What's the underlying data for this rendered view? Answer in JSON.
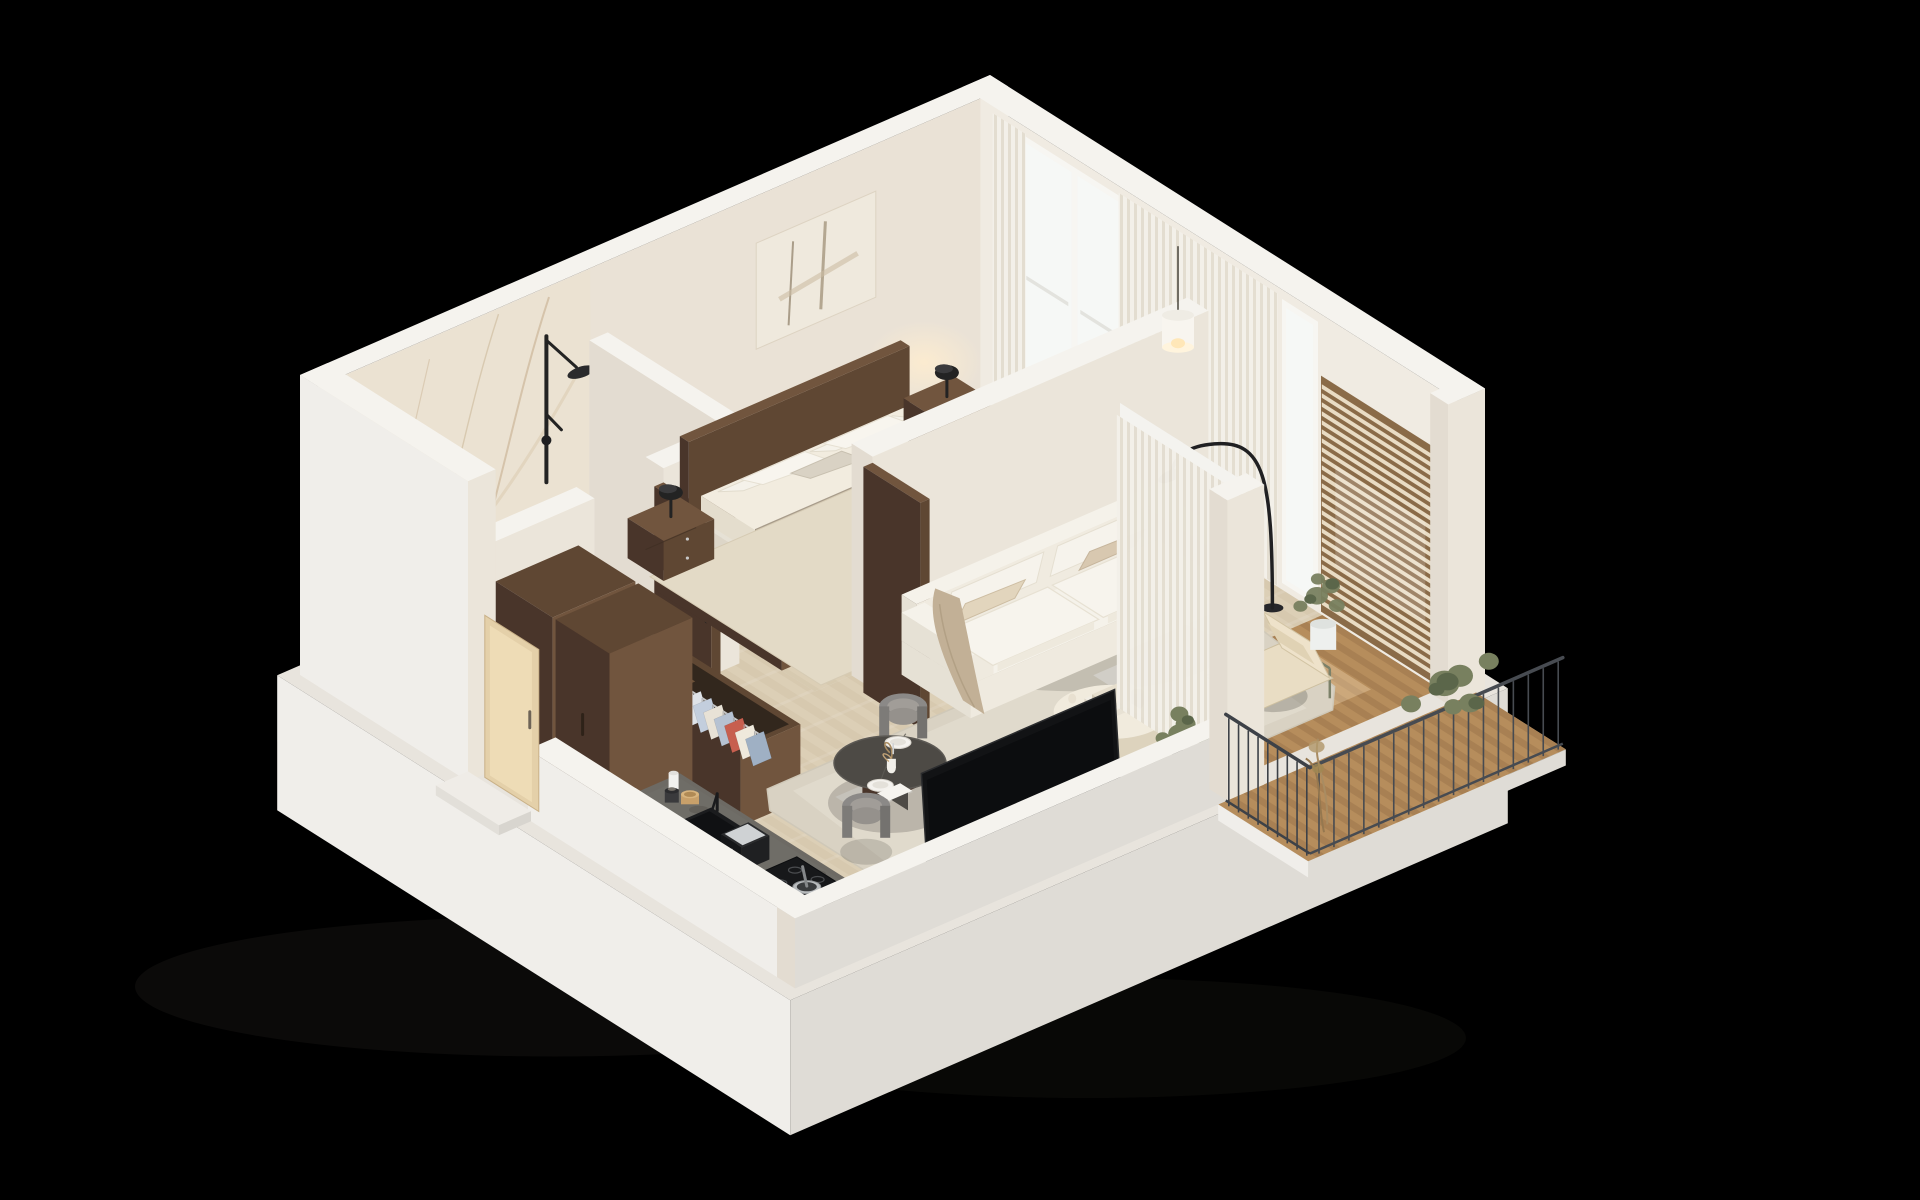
{
  "meta": {
    "description": "Photorealistic 3D isometric cutaway floor plan render of a studio apartment on a black background",
    "view": "axonometric cutaway, walls cut low at front",
    "background": "#000000"
  },
  "palette": {
    "background": "#000000",
    "wall_top": "#f5f3ee",
    "wall_face_left": "#e3dcd1",
    "wall_face_right": "#ebe5da",
    "wall_inner_back": "#eae2d6",
    "wall_inner_side": "#f0ebe2",
    "slab_top": "#e8e4dd",
    "slab_face_left": "#f0eeea",
    "slab_face_right": "#dfdcd6",
    "marble": "#ebe2d2",
    "marble_vein": "#c2aa88",
    "floor_wood": "#dccfb6",
    "floor_wood_dark": "#d0c2a7",
    "floor_bath": "#e7ddca",
    "floor_bath_seam": "#d8cbb4",
    "rug": "#d9d2c3",
    "rug_light": "#e8e2d5",
    "rug_bed": "#e3dac6",
    "deck": "#b68d5c",
    "deck_dark": "#99744a",
    "walnut": "#5f4733",
    "walnut_dark": "#49352a",
    "walnut_light": "#71553e",
    "white_furniture": "#f5f2ea",
    "white_shade": "#e6e1d5",
    "duvet": "#a89c8b",
    "duvet_light": "#b7ab9a",
    "linen": "#f2ecdf",
    "pillow_beige": "#d8c8b0",
    "throw": "#c2b096",
    "counter_stone": "#6d6a64",
    "counter_stone_dark": "#56534e",
    "counter_base": "#dedad2",
    "appliance_black": "#1b1c1e",
    "tv_black": "#121315",
    "chair_grey": "#8b8987",
    "table_wood": "#4d4a45",
    "curtain": "#f3f0e9",
    "curtain_shade": "#e3ddd0",
    "glass": "#e9eef0",
    "glass_bright": "#f6f8f6",
    "slat_wood": "#8a6b48",
    "slat_light": "#e9dcc4",
    "railing": "#474b51",
    "plant_green": "#78805f",
    "plant_dark": "#5b664a",
    "plant_dry": "#a98c62",
    "pot_white": "#eef0ee",
    "lamp_black": "#232323",
    "lamp_glow": "#ffedcf",
    "cream": "#ece4d2",
    "cream_dark": "#ddd3bd",
    "steel": "#b9bcbe",
    "chrome": "#cfd2d4",
    "door_light_wood": "#e4d0a9",
    "shadow": "#141310"
  },
  "rooms": [
    {
      "name": "bathroom",
      "items": [
        "marble feature wall",
        "black rain shower set",
        "freestanding oval bathtub",
        "wall-hung toilet",
        "walnut vanity with dark stone top and round white basin"
      ]
    },
    {
      "name": "bedroom",
      "items": [
        "double bed with walnut headboard",
        "white pillows",
        "taupe duvet",
        "walnut nightstand left",
        "walnut nightstand right",
        "black mushroom table lamps",
        "abstract textured artwork",
        "floor-to-ceiling window with sheer curtains",
        "open wardrobe with hanging clothes"
      ]
    },
    {
      "name": "hallway",
      "items": [
        "light wood entry door",
        "open closet with hanging clothes and shoe shelves",
        "tall walnut cabinets",
        "open walnut interior doors"
      ]
    },
    {
      "name": "living-room",
      "items": [
        "white three-seat sofa",
        "beige cushions and throw",
        "round cream coffee table with books and vases",
        "large flecked beige rug",
        "black arc floor lamp",
        "white cylinder pendant lamp",
        "round dark wood dining table with plates",
        "two grey barrel dining chairs",
        "TV console with black flat screen"
      ]
    },
    {
      "name": "kitchen",
      "items": [
        "dark stone countertop along low wall",
        "black undermount sink",
        "black induction cooktop with steel pan",
        "black coffee machine",
        "storage jars"
      ]
    },
    {
      "name": "balcony-loggia",
      "items": [
        "wood deck",
        "wood slat privacy screen",
        "metal frame lounge chair with cream cushions",
        "potted plant",
        "full-height sliding glass wall",
        "sheer curtain"
      ]
    },
    {
      "name": "exterior-balcony",
      "items": [
        "wood deck",
        "dark metal railing with vertical bars",
        "green plants",
        "dried plants"
      ]
    }
  ]
}
